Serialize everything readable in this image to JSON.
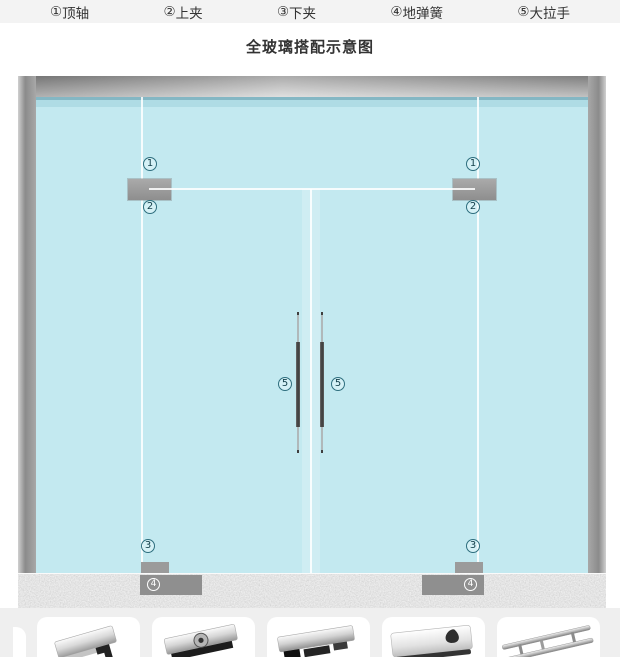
{
  "page": {
    "title": "全玻璃搭配示意图"
  },
  "legend": {
    "items": [
      {
        "num": "①",
        "label": "顶轴"
      },
      {
        "num": "②",
        "label": "上夹"
      },
      {
        "num": "③",
        "label": "下夹"
      },
      {
        "num": "④",
        "label": "地弹簧"
      },
      {
        "num": "⑤",
        "label": "大拉手"
      }
    ]
  },
  "diagram": {
    "callouts": {
      "top_pivot": "1",
      "upper_clamp": "2",
      "lower_clamp": "3",
      "floor_spring": "4",
      "handle": "5"
    },
    "colors": {
      "glass": "#c3e9f0",
      "frame_light": "#d2d2d2",
      "frame_dark": "#8a8a8a",
      "clamp_gray": "#9b9b9b",
      "callout_teal": "#2e6e7e",
      "floor_gray": "#dedede",
      "strip_bg": "#efefef"
    }
  },
  "products": {
    "cards": [
      {
        "icon": "corner-pivot-clamp-photo"
      },
      {
        "icon": "top-patch-clamp-photo"
      },
      {
        "icon": "bottom-patch-clamp-photo"
      },
      {
        "icon": "floor-spring-photo"
      },
      {
        "icon": "double-tube-handle-photo"
      }
    ]
  }
}
